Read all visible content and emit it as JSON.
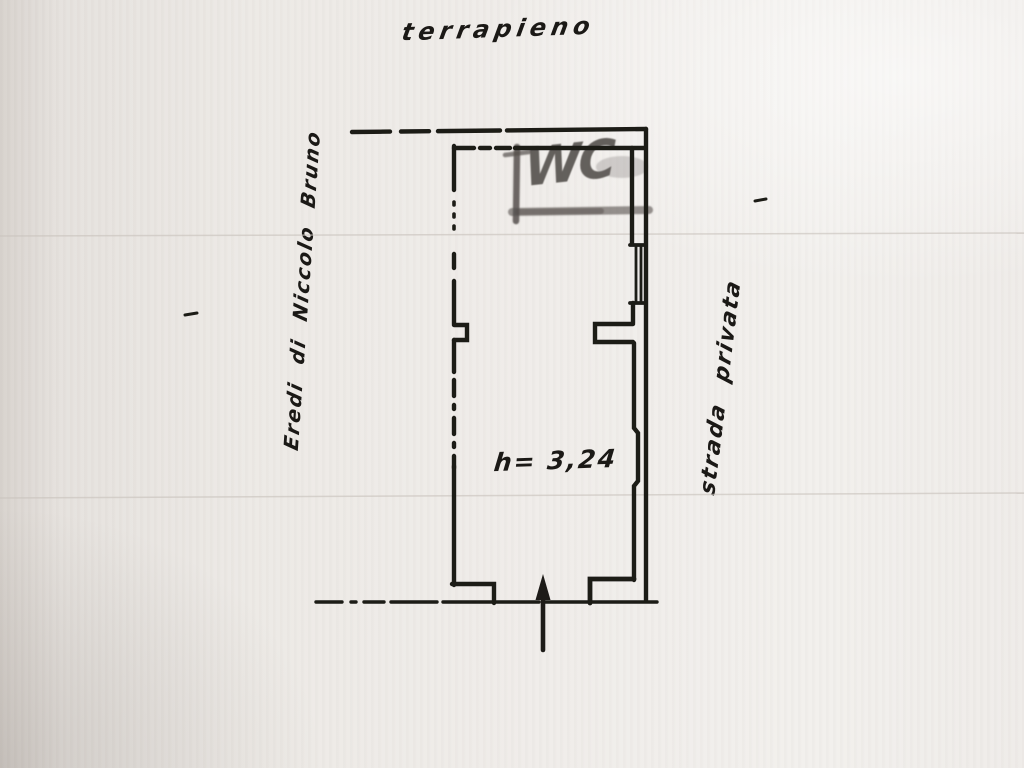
{
  "colors": {
    "paper": "#edeae6",
    "ink": "#1d1b18",
    "pencil": "#55504c",
    "scan_line": "#c9c3bd"
  },
  "labels": {
    "top": "terrapieno",
    "left": "Eredi di Niccolo Bruno",
    "right": "strada privata",
    "height_note": "h= 3,24",
    "wc": "WC"
  }
}
